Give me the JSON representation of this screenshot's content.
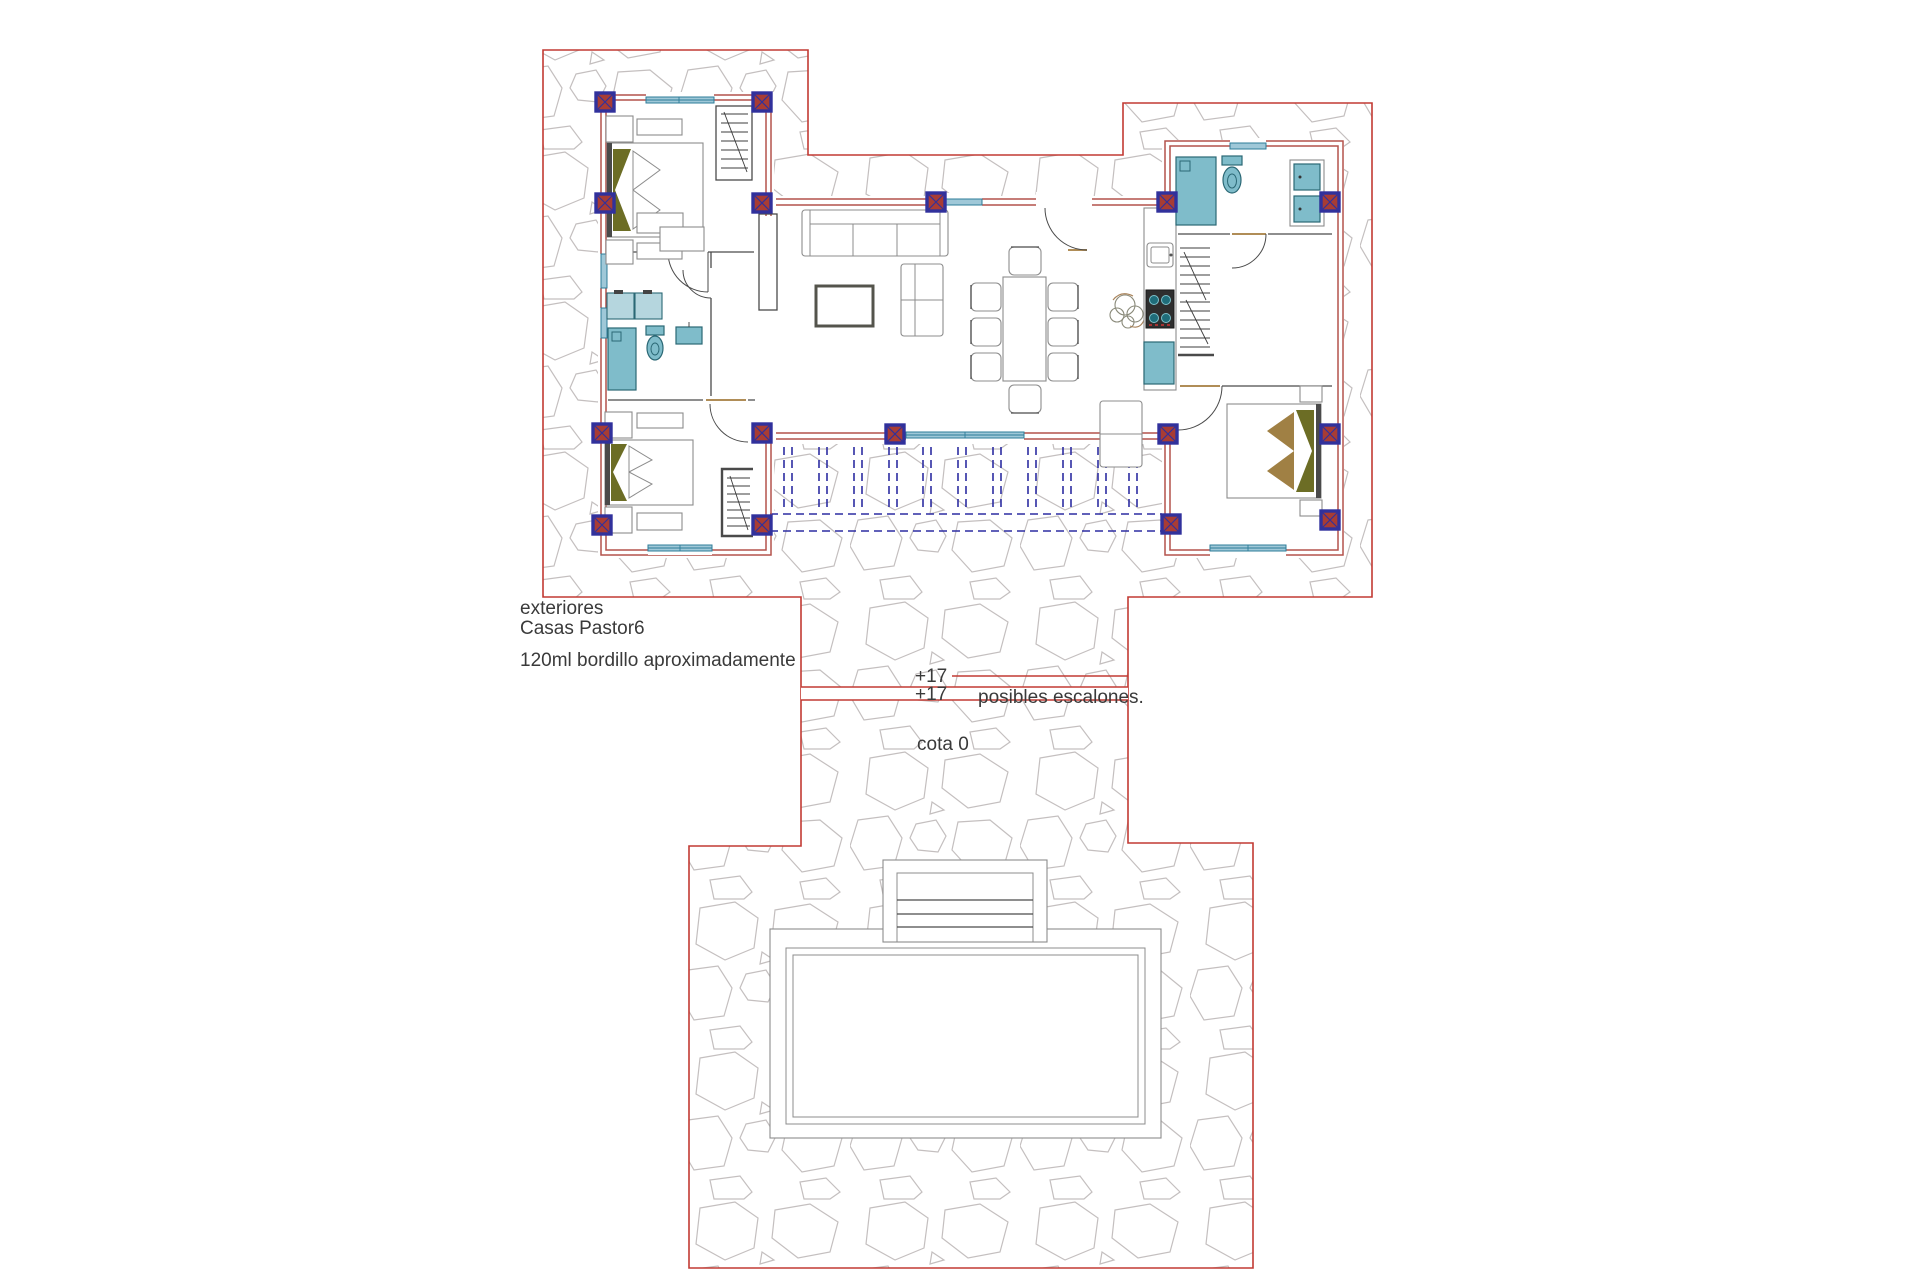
{
  "annotations": {
    "area_label": "exteriores",
    "project_name": "Casas Pastor6",
    "curb_note": "120ml bordillo aproximadamente",
    "level_top": "+17",
    "level_bottom": "+17",
    "steps_note": "posibles escalones.",
    "datum_label": "cota 0"
  },
  "colors": {
    "boundary": "#c23a33",
    "wall": "#b4524c",
    "pillar-blue": "#31319c",
    "pillar-red": "#a83c34",
    "fixture": "#7fbcca",
    "fixture-light": "#b5d6de",
    "fixture-border": "#2b6875",
    "window": "#9fc8d8",
    "window-line": "#2e7d99",
    "stone": "#c4bfbf",
    "furn": "#8c8c8c",
    "furn-dark": "#54544c",
    "pillow-olive": "#6c6d25",
    "pillow-tan": "#a08044",
    "pergola": "#2d2da2",
    "ink": "#3a3a3a",
    "tan": "#b08d57",
    "dark": "#4a4a4a"
  }
}
